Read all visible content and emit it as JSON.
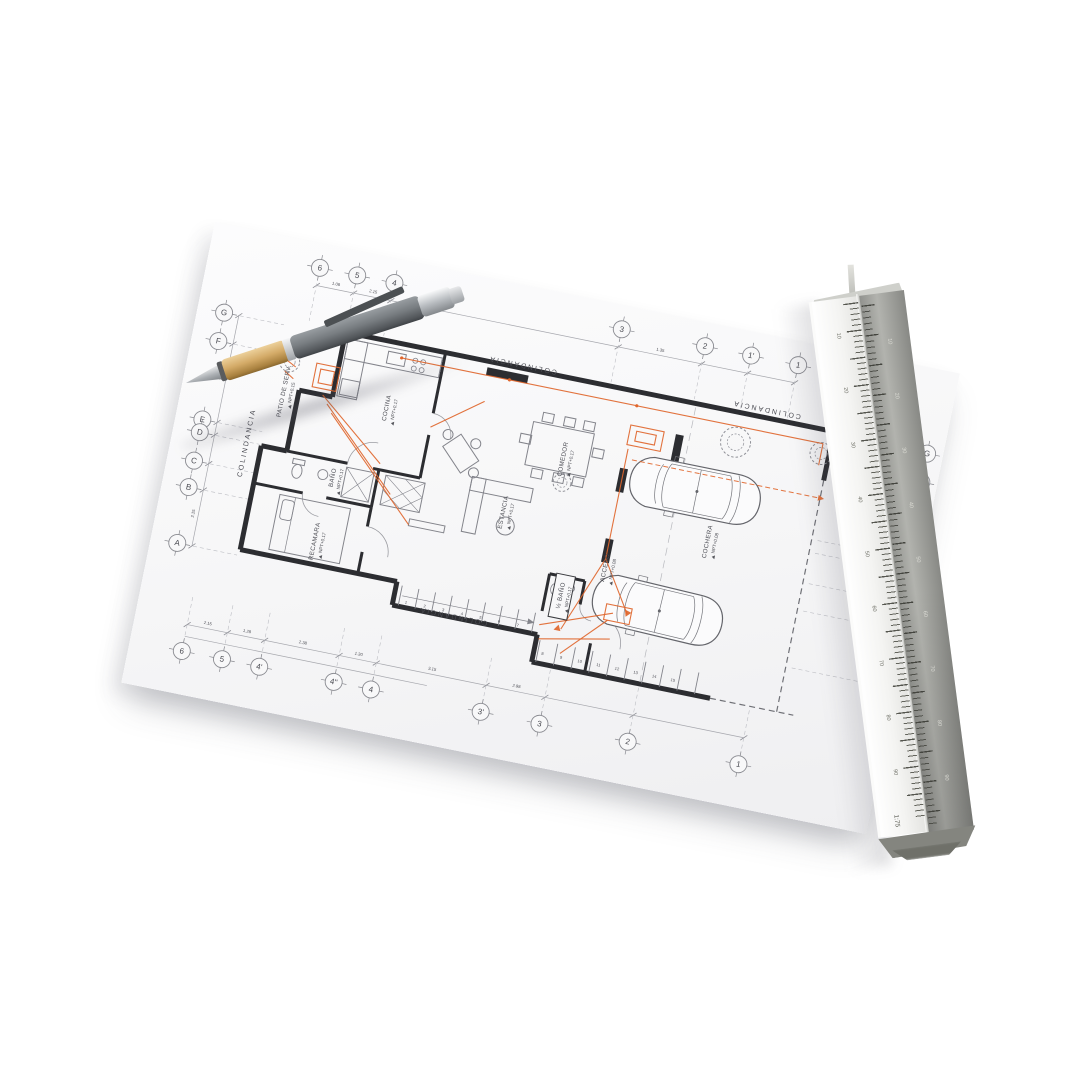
{
  "scene": {
    "description": "Photo of an architectural floor plan sheet with a ballpoint pen and a triangular aluminum scale ruler",
    "background_color": "#ffffff",
    "paper_color": "#f7f7f8",
    "wall_color": "#2c2d31",
    "thin_line_color": "#a6a7ad",
    "accent_color": "#e0662c"
  },
  "plan": {
    "border_labels": {
      "top": "COLINDANCIA",
      "top_right": "COLINDANCIA",
      "left": "COLINDANCIA",
      "bottom": "COLINDANCIA"
    },
    "grid": {
      "top_numbers": [
        "6",
        "5",
        "4",
        "3",
        "2",
        "1'",
        "1"
      ],
      "bottom_numbers": [
        "6",
        "5",
        "4'",
        "4''",
        "4",
        "3'",
        "3",
        "2",
        "1"
      ],
      "left_letters": [
        "G",
        "F",
        "E",
        "D",
        "C",
        "B",
        "A"
      ],
      "right_letters": [
        "G",
        "F",
        "E",
        "D",
        "C",
        "B",
        "A"
      ]
    },
    "rooms": [
      {
        "id": "patio",
        "name": "PATIO DE SERV.",
        "level": "NPT+0.15"
      },
      {
        "id": "cocina",
        "name": "COCINA",
        "level": "NPT+0.17"
      },
      {
        "id": "comedor",
        "name": "COMEDOR",
        "level": "NPT+0.17"
      },
      {
        "id": "estancia",
        "name": "ESTANCIA",
        "level": "NPT+0.17"
      },
      {
        "id": "bano",
        "name": "BAÑO",
        "level": "NPT+0.17"
      },
      {
        "id": "recamara",
        "name": "RECAMARA",
        "level": "NPT+0.17"
      },
      {
        "id": "medio_bano",
        "name": "½ BAÑO",
        "level": "NPT+0.17"
      },
      {
        "id": "acceso",
        "name": "ACCESO",
        "level": "NPT+0.08"
      },
      {
        "id": "cochera",
        "name": "COCHERA",
        "level": "NPT+0.08"
      }
    ],
    "stairs": {
      "flight1": [
        "1",
        "2",
        "3",
        "4",
        "5",
        "6",
        "7"
      ],
      "flight2": [
        "8",
        "9",
        "10",
        "11",
        "12",
        "13",
        "14",
        "15"
      ]
    },
    "dimensions": {
      "top": [
        "1.08",
        "2.15",
        "1.35"
      ],
      "bottom": [
        "2.15",
        "1.28",
        "2.38",
        "1.30",
        "3.15",
        "2.98"
      ],
      "left": [
        "1.08",
        "2.15"
      ],
      "right": [
        "1.35",
        "2.38"
      ]
    }
  },
  "ruler": {
    "scale_label": "1:75",
    "numbers": [
      "10",
      "20",
      "30",
      "40",
      "50",
      "60",
      "70",
      "80",
      "90"
    ]
  }
}
